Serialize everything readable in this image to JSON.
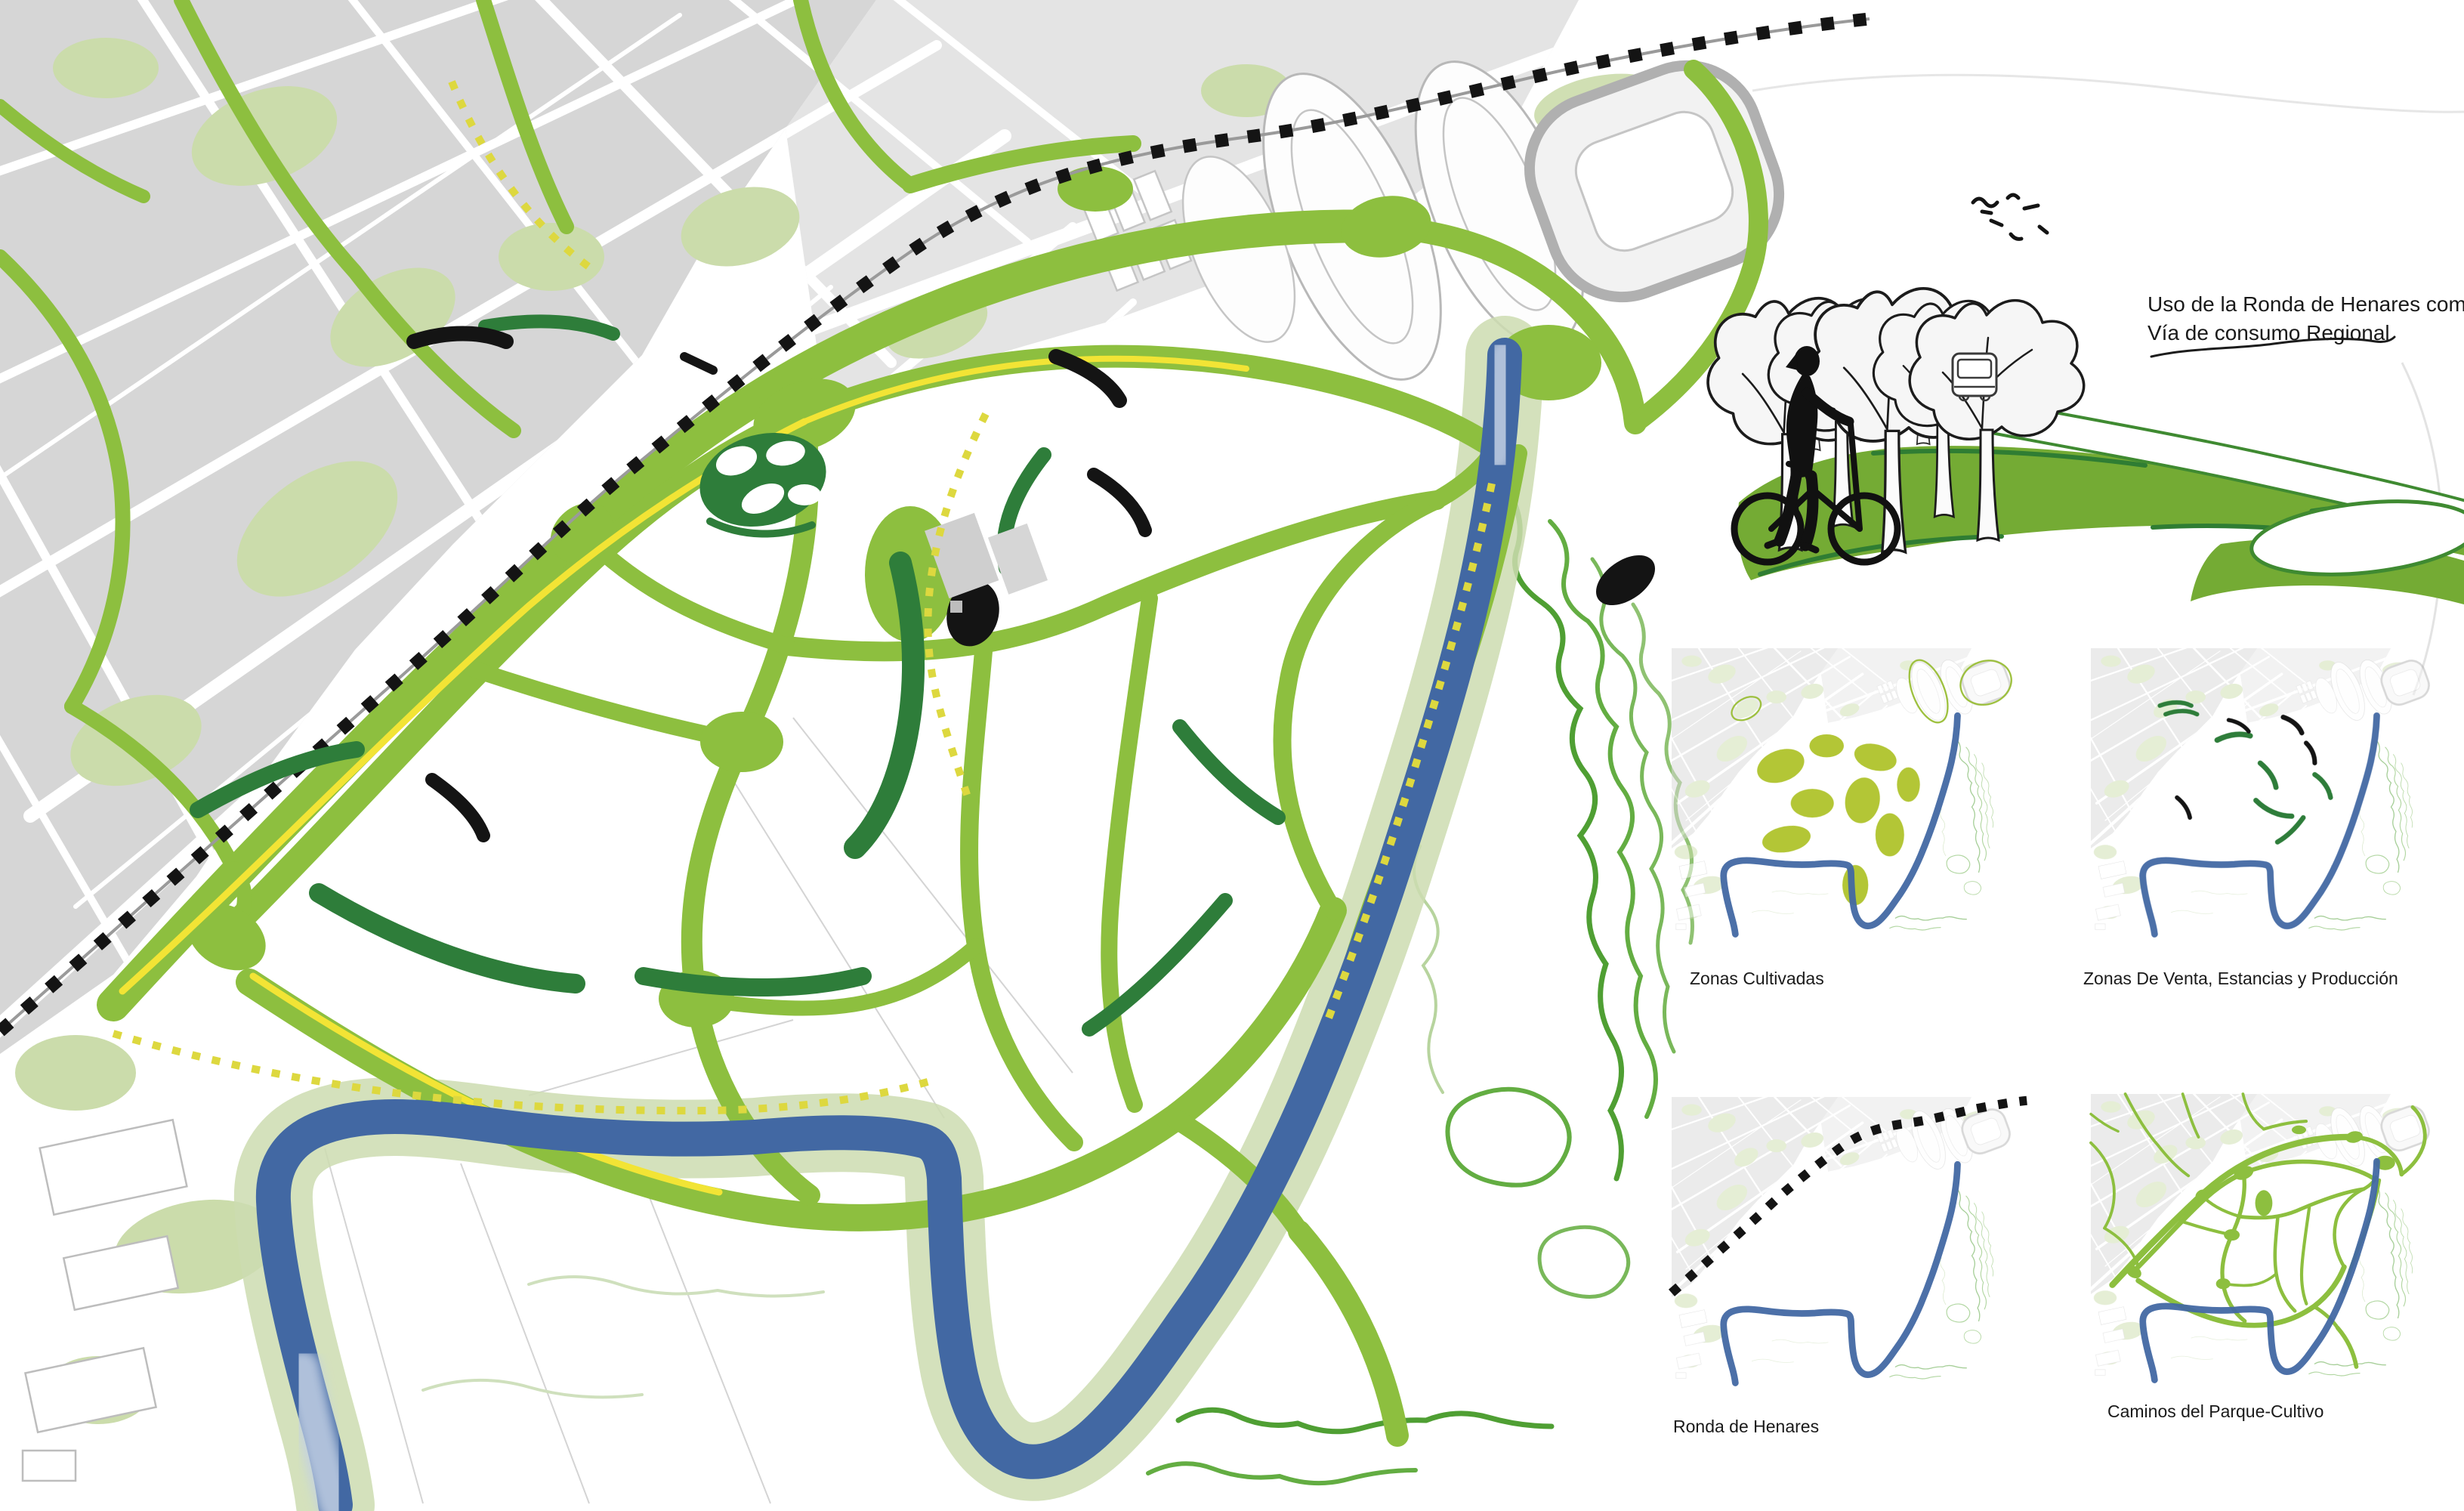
{
  "poster": {
    "title": "Parque-Cultivo del Henares masterplan",
    "annotation": {
      "line1": "Uso de la Ronda de Henares como",
      "line2": "Vía de consumo Regional"
    },
    "thumbnails": [
      {
        "label": "Zonas Cultivadas"
      },
      {
        "label": "Zonas  De Venta, Estancias y Producción"
      },
      {
        "label": "Ronda de Henares"
      },
      {
        "label": "Caminos del Parque-Cultivo"
      }
    ],
    "figures": {
      "cyclist": "cyclist-silhouette-icon",
      "trees": "sketch-trees-icon",
      "van": "van-icon",
      "birds": "birds-icon",
      "railway": "railway-dotted-line",
      "river": "henares-river"
    },
    "palette": {
      "corridor_green": "#8dbf3f",
      "dark_green": "#2e7d3a",
      "cultivation_green": "#b3c636",
      "sage_green": "#cddcb0",
      "contour_green": "#4f9f33",
      "river_blue": "#4268a3",
      "urban_gray": "#d6d6d6",
      "path_yellow": "#f2e435",
      "rail_black": "#141414",
      "text_black": "#1a1a1a"
    }
  }
}
